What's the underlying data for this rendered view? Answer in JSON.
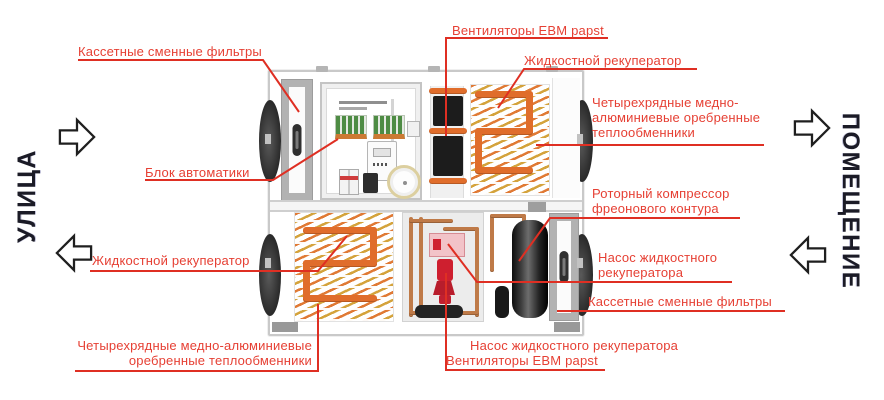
{
  "zones": {
    "left": "УЛИЦА",
    "right": "ПОМЕЩЕНИЕ"
  },
  "annotations": {
    "filters_top": "Кассетные сменные фильтры",
    "fans_top": "Вентиляторы EBM papst",
    "recuperator_top": "Жидкостной рекуператор",
    "heat_exchangers_right": {
      "line1": "Четырехрядные медно-",
      "line2": "алюминиевые оребренные",
      "line3": "теплообменники"
    },
    "compressor": {
      "line1": "Роторный компрессор",
      "line2": "фреонового контура"
    },
    "pump_right": {
      "line1": "Насос жидкостного",
      "line2": "рекуператора"
    },
    "filters_right": "Кассетные сменные фильтры",
    "pump_bottom": "Насос жидкостного рекуператора",
    "fans_bottom": "Вентиляторы EBM papst",
    "automation": "Блок автоматики",
    "recuperator_left": "Жидкостной рекуператор",
    "heat_exchangers_bottom": {
      "line1": "Четырехрядные медно-алюминиевые",
      "line2": "оребренные теплообменники"
    }
  },
  "colors": {
    "annotation_red": "#e64034",
    "leader_red": "#df2f23",
    "zone_text": "#1b1b26",
    "coil_orange": "#e06d2b",
    "coil_yellow": "#d4a33c"
  }
}
